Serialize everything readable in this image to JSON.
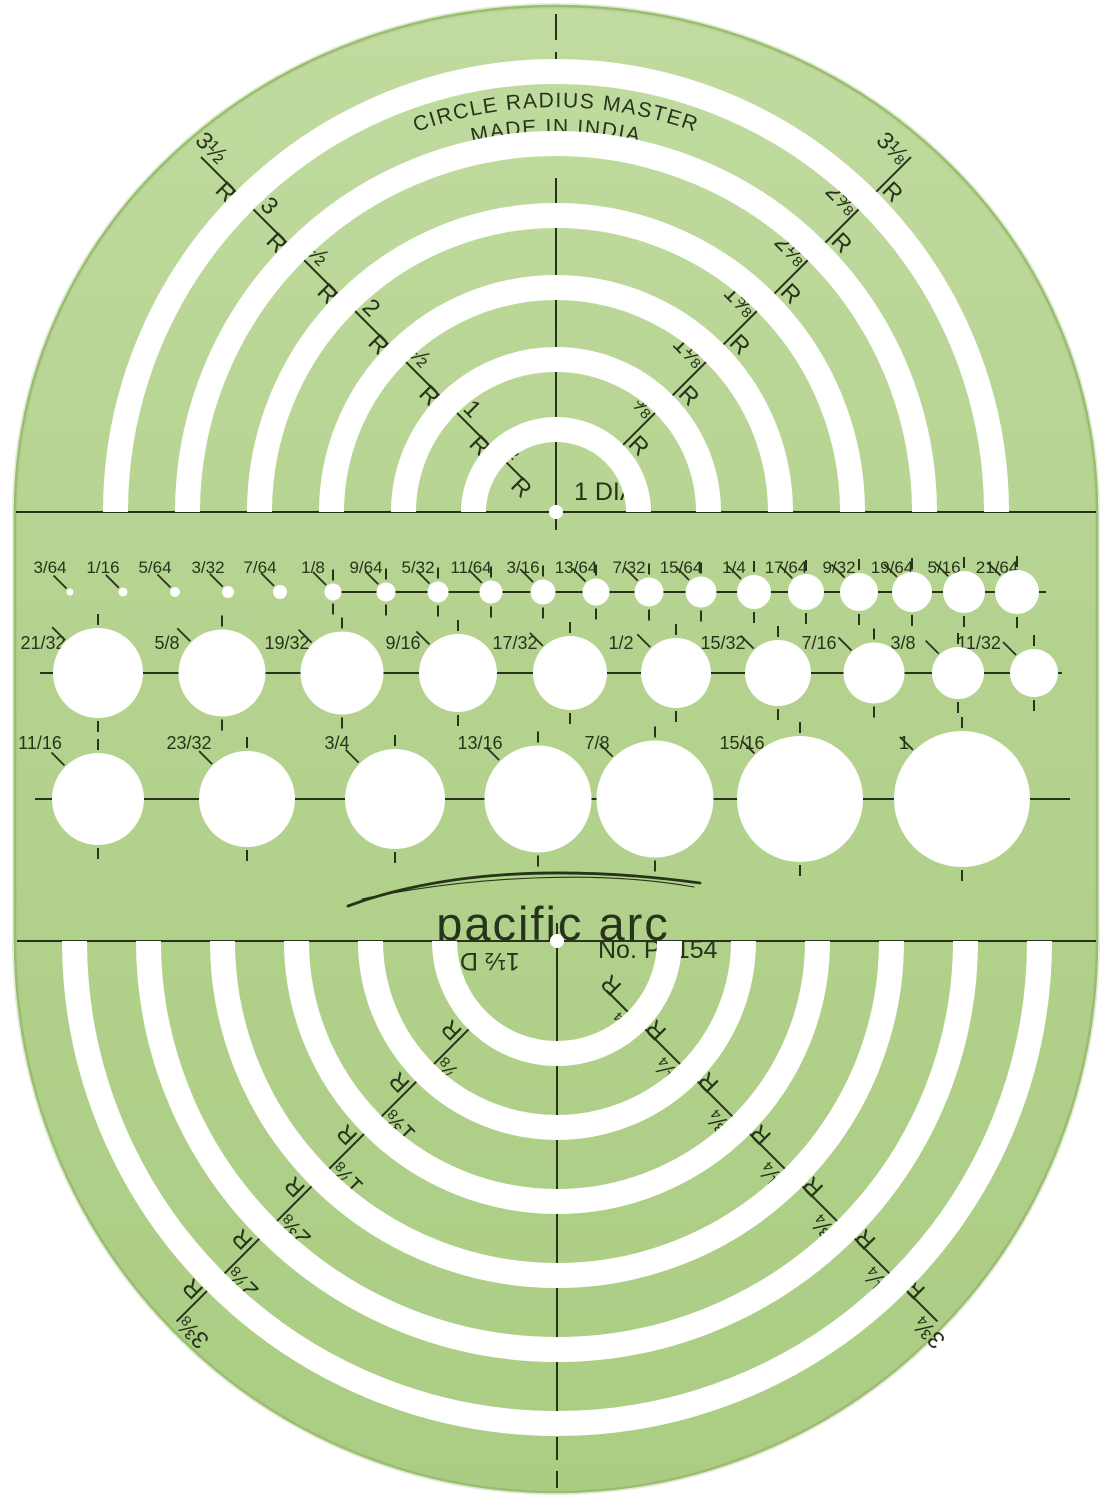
{
  "branding": {
    "title_line1": "CIRCLE RADIUS MASTER",
    "title_line2": "MADE IN INDIA",
    "logo": "pacific arc",
    "model_no": "No. PT154"
  },
  "colors": {
    "background": "#ffffff",
    "body_light": "#c1dba0",
    "body": "#b4d28e",
    "body_dark": "#abcd83",
    "edge": "#93b269",
    "ink": "#27331a",
    "cutout": "#ffffff"
  },
  "top_set": {
    "center_label": "1 DIA",
    "radius_suffix": "R",
    "radius_labels_left": [
      "½",
      "1",
      "1½",
      "2",
      "2½",
      "3",
      "3½"
    ],
    "radius_labels_right": [
      "⅝",
      "1⅛",
      "1⅝",
      "2⅛",
      "2⅝",
      "3⅛"
    ],
    "dia_labels_left": [
      "2 DIA",
      "3 DIA",
      "4 DIA",
      "5 DIA",
      "6 DIA",
      "7 DIA"
    ],
    "dia_labels_right": [
      "1¼ DIA",
      "2¼ DIA",
      "3¼ DIA",
      "4¼ DIA",
      "5¼ DIA",
      "6¼ DIA"
    ]
  },
  "bottom_set": {
    "center_label": "1½ DIA",
    "radius_suffix": "R",
    "radius_labels_left": [
      "⅞",
      "1⅜",
      "1⅞",
      "2⅜",
      "2⅞",
      "3⅜"
    ],
    "radius_labels_right": [
      "¾",
      "1¼",
      "1¾",
      "2¼",
      "2¾",
      "3¼",
      "3¾"
    ],
    "dia_labels_left": [
      "1¾ DIA",
      "2¾ DIA",
      "3¾ DIA",
      "4¾ DIA",
      "5¾ DIA",
      "6¾ DIA"
    ],
    "dia_labels_right": [
      "2½ DIA",
      "3½ DIA",
      "4½ DIA",
      "5½ DIA",
      "6½ DIA",
      "7½ DIA"
    ]
  },
  "hole_rows": [
    {
      "labels": [
        "3/64",
        "1/16",
        "5/64",
        "3/32",
        "7/64",
        "1/8",
        "9/64",
        "5/32",
        "11/64",
        "3/16",
        "13/64",
        "7/32",
        "15/64",
        "1/4",
        "17/64",
        "9/32",
        "19/64",
        "5/16",
        "21/64"
      ]
    },
    {
      "labels": [
        "21/32",
        "5/8",
        "19/32",
        "9/16",
        "17/32",
        "1/2",
        "15/32",
        "7/16",
        "3/8",
        "11/32"
      ]
    },
    {
      "labels": [
        "11/16",
        "23/32",
        "3/4",
        "13/16",
        "7/8",
        "15/16",
        "1"
      ]
    }
  ],
  "geometry": {
    "width": 1113,
    "height": 1500,
    "capsule": {
      "left": 15,
      "right": 1097,
      "topRx": 541,
      "topRy": 506,
      "botRy": 551
    },
    "top": {
      "cx": 556,
      "cy": 512,
      "disc_r": 70,
      "hole_r": 7,
      "slot_w": 25,
      "slot_inner": [
        70,
        140,
        212,
        284,
        356,
        428
      ],
      "dia_r": [
        117.5,
        188.5,
        260.5,
        332.5,
        404.5,
        484
      ],
      "r_left_spans": [
        [
          45,
          72
        ],
        [
          93,
          142
        ],
        [
          163,
          214
        ],
        [
          235,
          286
        ],
        [
          307,
          358
        ],
        [
          379,
          430
        ],
        [
          451,
          502
        ]
      ],
      "r_right_spans": [
        [
          93,
          142
        ],
        [
          163,
          214
        ],
        [
          235,
          286
        ],
        [
          307,
          358
        ],
        [
          379,
          430
        ],
        [
          451,
          502
        ]
      ]
    },
    "bottom": {
      "cx": 557,
      "cy": 941,
      "disc_r": 100,
      "hole_r": 7,
      "slot_w": 25,
      "slot_inner": [
        100,
        174,
        248,
        322,
        396,
        470
      ],
      "dia_r": [
        149.5,
        223.5,
        297.5,
        371.5,
        445.5,
        510
      ],
      "r_left_spans": [
        [
          123,
          176
        ],
        [
          197,
          250
        ],
        [
          271,
          324
        ],
        [
          345,
          398
        ],
        [
          419,
          472
        ],
        [
          493,
          538
        ]
      ],
      "r_right_spans": [
        [
          70,
          102
        ],
        [
          123,
          176
        ],
        [
          197,
          250
        ],
        [
          271,
          324
        ],
        [
          345,
          398
        ],
        [
          419,
          472
        ],
        [
          493,
          538
        ]
      ]
    },
    "rows": [
      {
        "y": 592,
        "label_y": 573,
        "x": [
          70,
          123,
          175,
          228,
          280,
          333,
          386,
          438,
          491,
          543,
          596,
          649,
          701,
          754,
          806,
          859,
          912,
          964,
          1017
        ],
        "d": [
          7,
          9,
          10,
          12,
          14,
          17,
          19,
          21,
          23,
          25,
          27,
          29,
          31,
          34,
          36,
          38,
          40,
          42,
          44
        ],
        "line_x": [
          326,
          1046
        ],
        "label_dx": -20,
        "font": 17
      },
      {
        "y": 673,
        "label_y": 649,
        "x": [
          98,
          222,
          342,
          458,
          570,
          676,
          778,
          874,
          958,
          1034
        ],
        "d": [
          90,
          87,
          83,
          78,
          74,
          70,
          66,
          61,
          52,
          48
        ],
        "line_x": [
          40,
          1062
        ],
        "label_dx": -55,
        "font": 18
      },
      {
        "y": 799,
        "label_y": 749,
        "x": [
          98,
          247,
          395,
          538,
          655,
          800,
          962
        ],
        "d": [
          92,
          96,
          100,
          107,
          117,
          126,
          136
        ],
        "line_x": [
          35,
          1070
        ],
        "label_dx": -58,
        "font": 18
      }
    ],
    "title": {
      "path1": "M 385 145 A 405 405 0 0 1 727 145",
      "path2": "M 396 169 A 378 378 0 0 1 716 169"
    },
    "logo": {
      "x": 553,
      "y": 940,
      "swoosh1": "M 348 906 C 440 872 560 864 700 883",
      "swoosh2": "M 362 899 C 470 876 600 870 694 887"
    },
    "model": {
      "x": 598,
      "y": 958
    },
    "center_label_top": {
      "x": 574,
      "y": 500
    },
    "center_label_bottom": {
      "x": 478,
      "y": 953
    }
  }
}
